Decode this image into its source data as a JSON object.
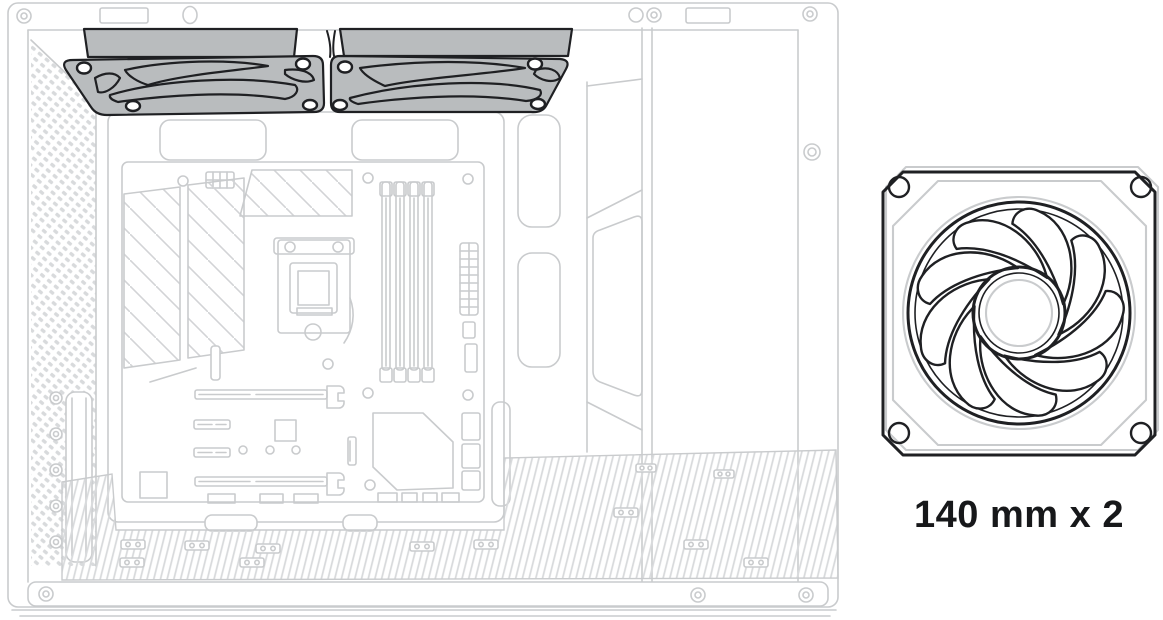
{
  "figure": {
    "caption": "140 mm x 2"
  },
  "illustration": {
    "highlight": "top-fans",
    "fan_count": 2
  },
  "colors": {
    "background": "#ffffff",
    "case_line": "#c9cbcd",
    "vent_line": "#d8dadc",
    "outline": "#1f2023",
    "fan_fill": "#b9bcbe",
    "caption": "#17181a"
  }
}
